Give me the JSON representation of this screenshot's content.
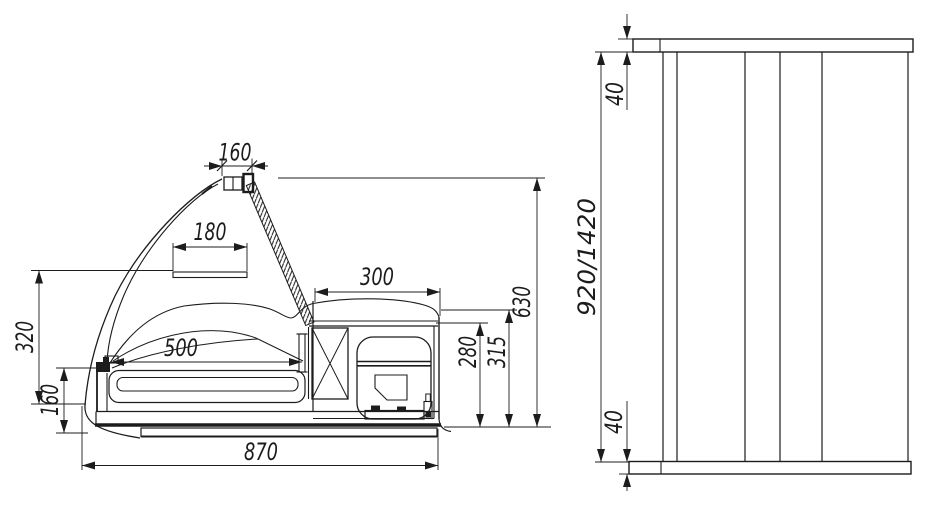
{
  "drawing": {
    "background_color": "#ffffff",
    "line_color": "#1c1c1c",
    "side_view": {
      "dims": {
        "lamp_width": "160",
        "shelf_width": "180",
        "display_depth": "500",
        "machine_compartment_width": "300",
        "overall_height": "630",
        "machine_compartment_height": "315",
        "inner_compartment_height": "280",
        "front_glass_height": "320",
        "front_panel_height": "160",
        "overall_depth": "870"
      }
    },
    "front_view": {
      "dims": {
        "top_panel_thickness": "40",
        "case_length": "920/1420",
        "bottom_panel_thickness": "40"
      }
    }
  }
}
